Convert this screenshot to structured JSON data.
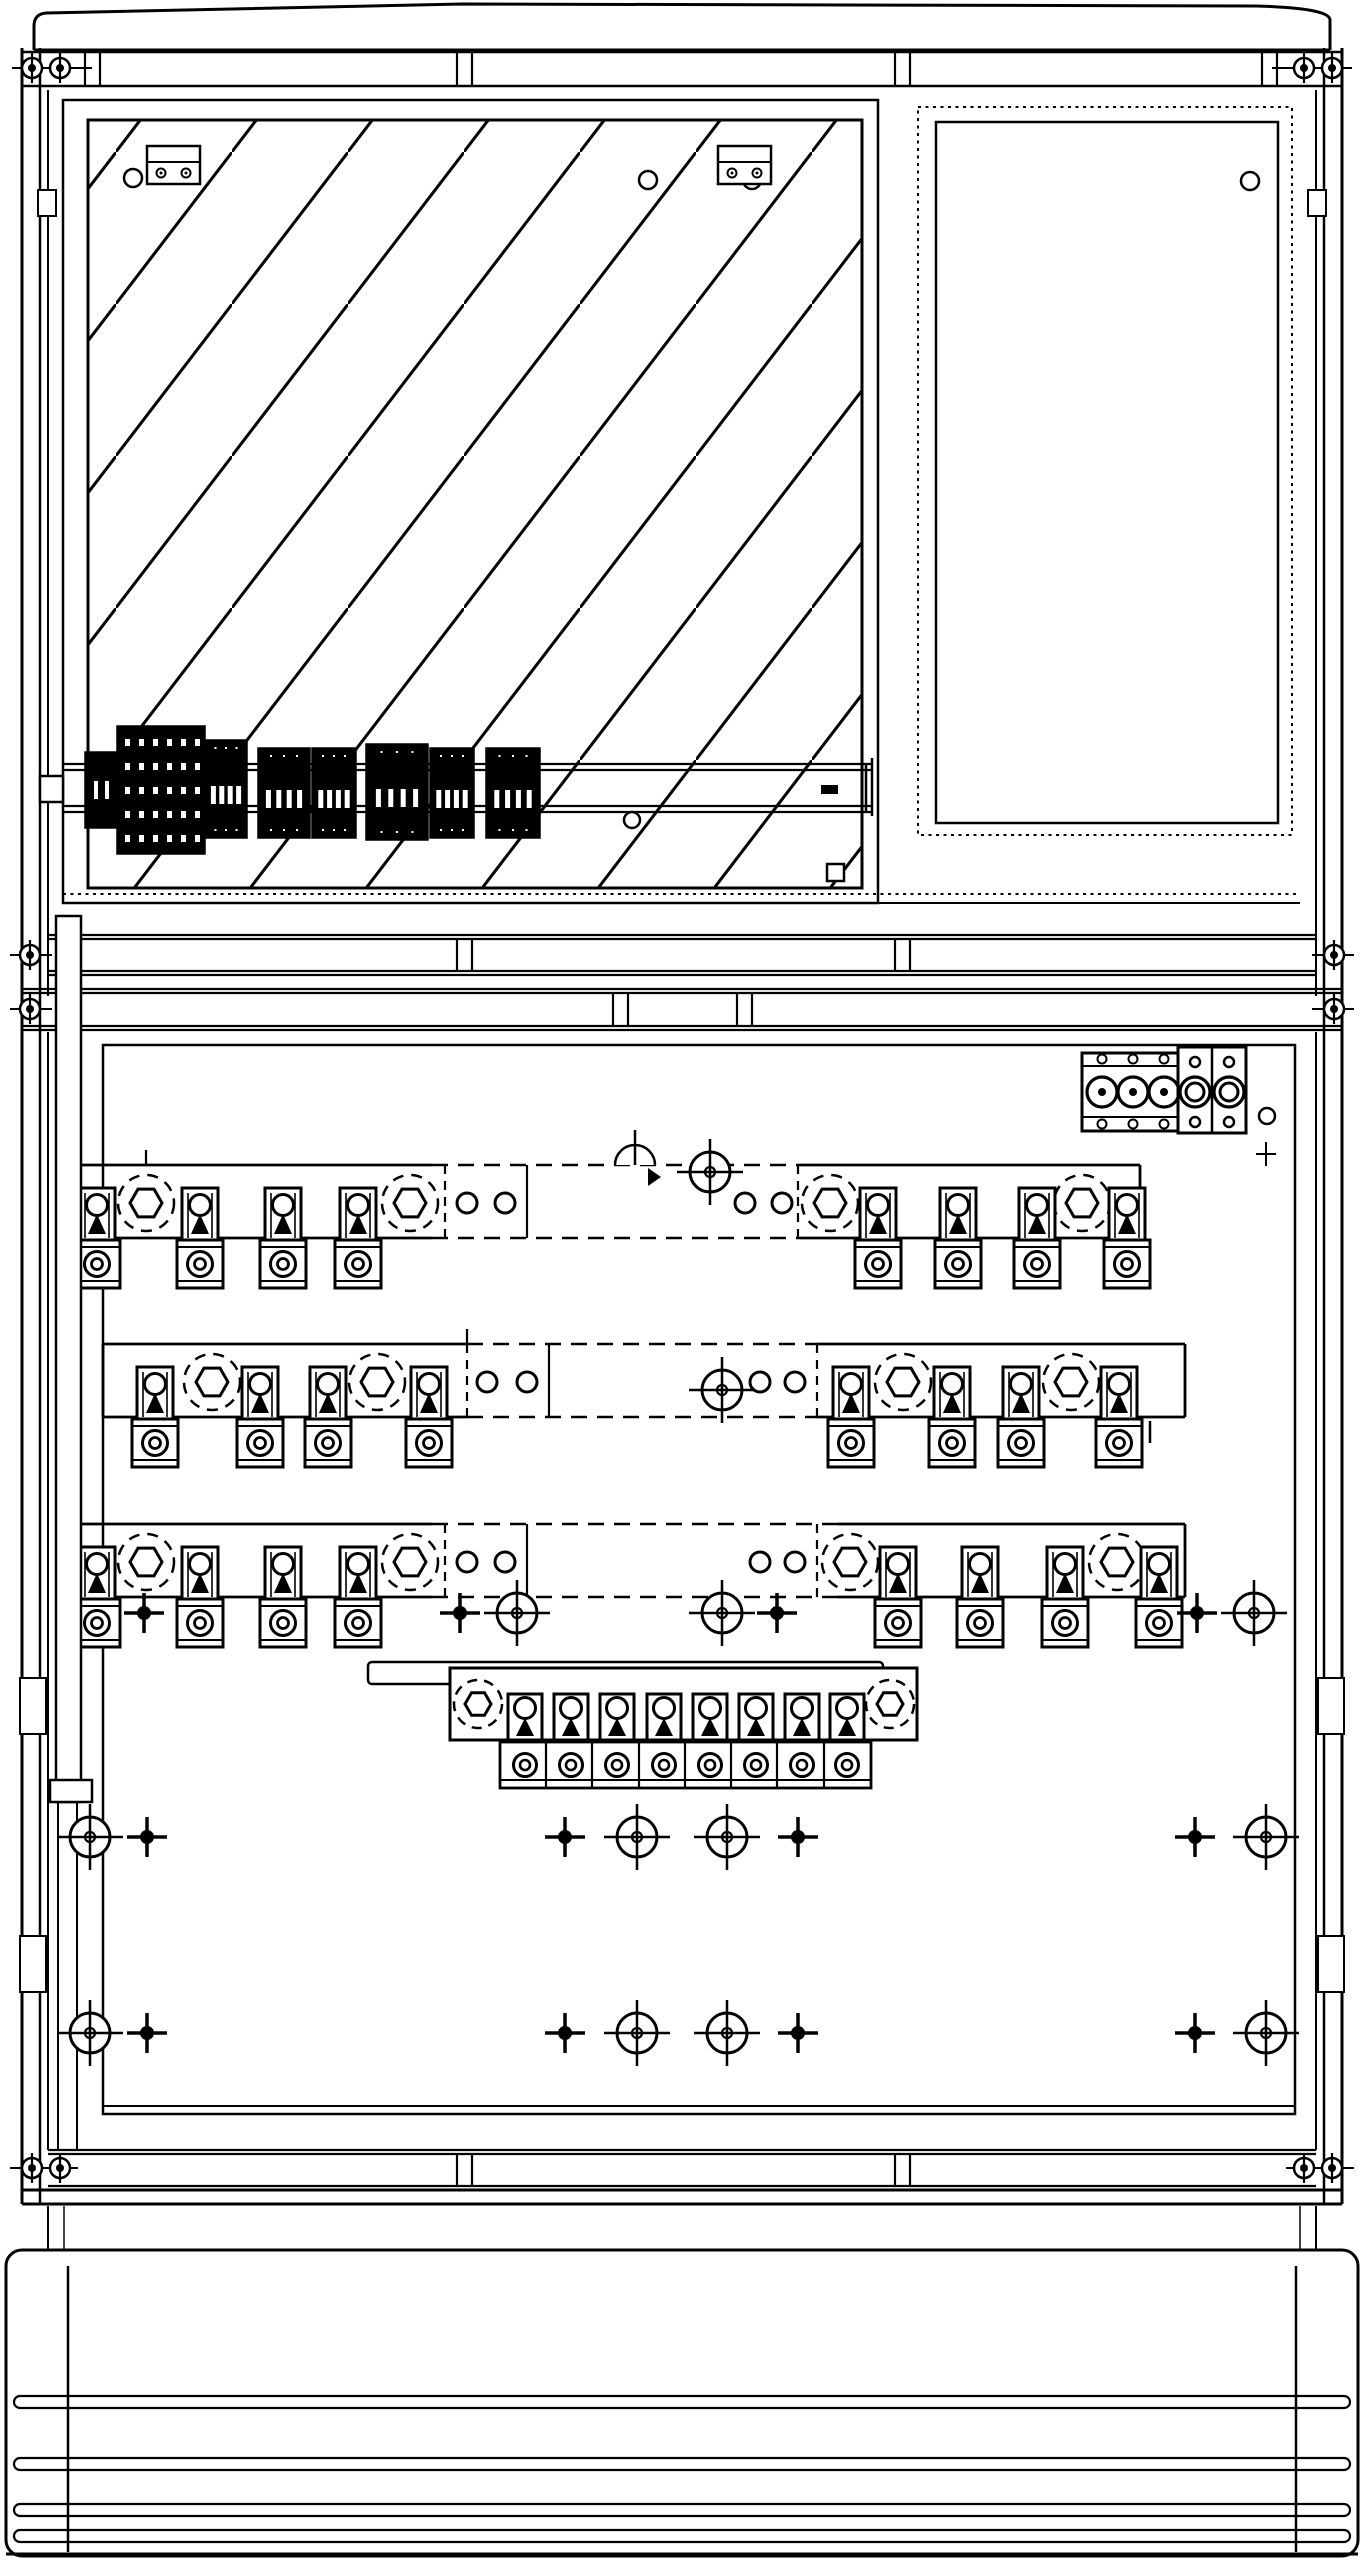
{
  "meta": {
    "title": "Cable distribution cabinet - front view technical line drawing"
  },
  "colors": {
    "line": "#000000",
    "background": "#ffffff"
  },
  "canvas": {
    "width": 1364,
    "height": 2560
  },
  "frame": {
    "cap_path": "M34,50 L34,26 Q34,14 46,13 L462,4 L1256,6 Q1330,8 1330,20 L1330,50",
    "lines": [
      [
        34,
        50,
        1330,
        50,
        3
      ],
      [
        22,
        52,
        1342,
        52,
        2.5
      ],
      [
        22,
        86,
        1342,
        86,
        2.5
      ],
      [
        22,
        48,
        22,
        2204,
        3
      ],
      [
        40,
        48,
        40,
        2204,
        2.5
      ],
      [
        1342,
        48,
        1342,
        2204,
        3
      ],
      [
        1324,
        48,
        1324,
        2204,
        2.5
      ],
      [
        48,
        90,
        48,
        996,
        2
      ],
      [
        1316,
        90,
        1316,
        996,
        2
      ],
      [
        48,
        1032,
        48,
        2150,
        2
      ],
      [
        1316,
        1032,
        1316,
        2150,
        2
      ],
      [
        63,
        894,
        1300,
        894,
        2,
        "3 4.5"
      ],
      [
        63,
        903,
        1300,
        903,
        2
      ],
      [
        48,
        935,
        1316,
        935,
        2.2
      ],
      [
        48,
        939,
        1316,
        939,
        2.2
      ],
      [
        48,
        971,
        1316,
        971,
        2.2
      ],
      [
        48,
        975,
        1316,
        975,
        2.2
      ],
      [
        22,
        989,
        1342,
        989,
        2.2
      ],
      [
        22,
        993,
        1342,
        993,
        2.2
      ],
      [
        22,
        1026,
        1342,
        1026,
        2.2
      ],
      [
        22,
        1030,
        1342,
        1030,
        2.2
      ],
      [
        103,
        2106,
        1295,
        2106,
        2
      ],
      [
        48,
        2150,
        1316,
        2150,
        2.2
      ],
      [
        48,
        2154,
        1316,
        2154,
        2.2
      ],
      [
        48,
        2186,
        1316,
        2186,
        2.2
      ],
      [
        22,
        2190,
        1342,
        2190,
        3
      ],
      [
        22,
        2204,
        1342,
        2204,
        3
      ],
      [
        48,
        2206,
        48,
        2250,
        2
      ],
      [
        1316,
        2206,
        1316,
        2250,
        2
      ],
      [
        64,
        2206,
        64,
        2250,
        1.5
      ],
      [
        1300,
        2206,
        1300,
        2250,
        1.5
      ],
      [
        68,
        2266,
        68,
        2552,
        2.5
      ],
      [
        1296,
        2266,
        1296,
        2552,
        2.5
      ],
      [
        6,
        2554,
        1358,
        2554,
        3
      ],
      [
        58,
        1802,
        58,
        2150,
        2
      ],
      [
        77,
        1802,
        77,
        2150,
        2
      ],
      [
        12,
        68,
        92,
        68,
        2
      ],
      [
        1272,
        68,
        1352,
        68,
        2
      ],
      [
        10,
        955,
        52,
        955,
        2
      ],
      [
        1312,
        955,
        1354,
        955,
        2
      ],
      [
        10,
        1009,
        52,
        1009,
        2
      ],
      [
        1312,
        1009,
        1354,
        1009,
        2
      ],
      [
        10,
        2168,
        78,
        2168,
        2
      ],
      [
        1286,
        2168,
        1354,
        2168,
        2
      ]
    ],
    "rects": [
      [
        63,
        100,
        815,
        803,
        2.5,
        "none"
      ],
      [
        918,
        107,
        374,
        728,
        2,
        "none",
        "3 4.5"
      ],
      [
        936,
        122,
        342,
        701,
        2.5,
        "none"
      ],
      [
        103,
        1045,
        1192,
        1069,
        2.5,
        "none"
      ],
      [
        38,
        190,
        18,
        26,
        2,
        "#ffffff"
      ],
      [
        1308,
        190,
        18,
        26,
        2,
        "#ffffff"
      ],
      [
        20,
        1678,
        26,
        56,
        2,
        "#ffffff"
      ],
      [
        1318,
        1678,
        26,
        56,
        2,
        "#ffffff"
      ],
      [
        20,
        1936,
        26,
        56,
        2,
        "#ffffff"
      ],
      [
        1318,
        1936,
        26,
        56,
        2,
        "#ffffff"
      ]
    ],
    "plinth": {
      "rect": [
        6,
        2250,
        1352,
        306
      ],
      "corner_radius": 16,
      "stroke": 3,
      "grooves_y": [
        2396,
        2458,
        2504,
        2530
      ],
      "groove": {
        "x": 14,
        "w": 1336,
        "h": 12,
        "stroke": 2.2
      }
    },
    "tick_pairs": {
      "gap": 15,
      "stroke": 2.2,
      "sets": [
        {
          "y1": 52,
          "y2": 86,
          "xs": [
            85,
            457,
            895,
            1262
          ]
        },
        {
          "y1": 939,
          "y2": 971,
          "xs": [
            457,
            895
          ]
        },
        {
          "y1": 993,
          "y2": 1026,
          "xs": [
            613,
            737
          ]
        },
        {
          "y1": 2154,
          "y2": 2186,
          "xs": [
            457,
            895
          ]
        }
      ]
    },
    "bolts": [
      {
        "x": 32,
        "y": 68
      },
      {
        "x": 60,
        "y": 68
      },
      {
        "x": 1304,
        "y": 68
      },
      {
        "x": 1332,
        "y": 68
      },
      {
        "x": 30,
        "y": 955
      },
      {
        "x": 1334,
        "y": 955
      },
      {
        "x": 30,
        "y": 1009
      },
      {
        "x": 1334,
        "y": 1009
      },
      {
        "x": 32,
        "y": 2168
      },
      {
        "x": 60,
        "y": 2168
      },
      {
        "x": 1304,
        "y": 2168
      },
      {
        "x": 1332,
        "y": 2168
      }
    ]
  },
  "hatch_panel": {
    "rect": [
      88,
      120,
      774,
      768
    ],
    "pattern": {
      "w": 116,
      "h": 152,
      "stroke": 3
    },
    "circles": [
      [
        133,
        178
      ],
      [
        648,
        180
      ],
      [
        752,
        180
      ]
    ],
    "circle_r": 9,
    "brackets": [
      {
        "x": 147,
        "y": 146
      },
      {
        "x": 718,
        "y": 146
      }
    ],
    "bracket": {
      "w": 53,
      "h": 38,
      "divider_y": 16,
      "screw_dx": [
        14,
        39
      ],
      "screw_dy": 27,
      "screw_r": 4.5
    }
  },
  "door_panel": {
    "circle": [
      1250,
      181,
      9
    ]
  },
  "din_rail": {
    "lines": [
      [
        63,
        764,
        872,
        764
      ],
      [
        63,
        770,
        872,
        770
      ],
      [
        63,
        806,
        872,
        806
      ],
      [
        63,
        812,
        872,
        812
      ]
    ],
    "line_w": 2.2,
    "end_verticals": [
      [
        866,
        764,
        866,
        812
      ],
      [
        872,
        758,
        872,
        816
      ]
    ],
    "left_connector": [
      40,
      776,
      23,
      26
    ],
    "dots": [
      [
        92,
        816
      ],
      [
        104,
        816
      ]
    ],
    "dot_r": 3,
    "dash_mark": [
      822,
      786,
      15,
      7
    ],
    "square_mark": [
      827,
      864,
      17,
      17
    ],
    "circle_below": [
      632,
      820,
      8
    ],
    "blocks": [
      {
        "x": 85,
        "y": 752,
        "w": 32,
        "h": 76,
        "kind": "side"
      },
      {
        "x": 117,
        "y": 726,
        "w": 88,
        "h": 128,
        "kind": "big"
      },
      {
        "x": 205,
        "y": 740,
        "w": 42,
        "h": 98,
        "kind": "std"
      },
      {
        "x": 258,
        "y": 748,
        "w": 52,
        "h": 90,
        "kind": "std"
      },
      {
        "x": 312,
        "y": 748,
        "w": 44,
        "h": 90,
        "kind": "std"
      },
      {
        "x": 366,
        "y": 744,
        "w": 62,
        "h": 96,
        "kind": "std"
      },
      {
        "x": 430,
        "y": 748,
        "w": 44,
        "h": 90,
        "kind": "std"
      },
      {
        "x": 486,
        "y": 748,
        "w": 54,
        "h": 90,
        "kind": "std"
      }
    ]
  },
  "duct": {
    "body": [
      56,
      916,
      25,
      886
    ],
    "foot": [
      50,
      1780,
      42,
      22
    ]
  },
  "connector_block": {
    "block_a": {
      "rect": [
        1082,
        1053,
        96,
        78
      ],
      "h_lines_y": [
        1066,
        1117
      ],
      "big_circles_x": [
        1102,
        1133,
        1164
      ],
      "big_circle_y": 1092,
      "big_r": 15,
      "dot_r": 4,
      "small_circles_y": [
        1059,
        1124
      ],
      "small_r": 4.5
    },
    "block_b": {
      "rect": [
        1178,
        1047,
        68,
        86
      ],
      "divider_x": 1212,
      "cells_x": [
        1195,
        1229
      ],
      "ring_y": 1092,
      "ring_r": [
        15,
        9
      ],
      "small_y": [
        1062,
        1122
      ],
      "small_r": 5
    },
    "side_circle": [
      1267,
      1116,
      8
    ],
    "mini_plus": [
      1266,
      1154
    ]
  },
  "busbar_style": {
    "band_h": 73,
    "bar_stroke": 2.8,
    "hidden_dash": "16 10",
    "clamp": {
      "w": 36,
      "h": 54,
      "dy": 23
    },
    "pad": {
      "w": 46,
      "h": 48,
      "dy": 75
    },
    "hex": {
      "ring_r": 28,
      "hex_r": 16
    },
    "circle_r": 10
  },
  "busbar_rows": [
    {
      "name": "busbar-row-L1",
      "band_top": 1165,
      "x1": 80,
      "x2": 1140,
      "dashed": [
        432,
        800
      ],
      "hexes": [
        146,
        410,
        830,
        1082
      ],
      "clamps": [
        97,
        200,
        283,
        358,
        878,
        958,
        1037,
        1127
      ],
      "circles": [
        467,
        505,
        745,
        782
      ],
      "targets": [
        [
          710,
          1172
        ]
      ],
      "half_markers": [
        [
          635,
          1165
        ]
      ],
      "dash_verts": [
        445,
        798
      ],
      "solid_verts": [
        527
      ],
      "top_ticks": [
        146
      ],
      "end_ticks": [
        [
          1145,
          1242
        ]
      ]
    },
    {
      "name": "busbar-row-L2",
      "band_top": 1344,
      "x1": 103,
      "x2": 1185,
      "dashed": [
        467,
        817
      ],
      "hexes": [
        212,
        377,
        903,
        1071
      ],
      "clamps": [
        155,
        260,
        328,
        429,
        851,
        952,
        1021,
        1119
      ],
      "circles": [
        487,
        527,
        760,
        795
      ],
      "targets": [
        [
          722,
          1390
        ]
      ],
      "half_markers": [],
      "dash_verts": [
        467,
        817
      ],
      "solid_verts": [
        549
      ],
      "top_ticks": [
        467
      ],
      "end_ticks": [
        [
          1150,
          1421
        ]
      ]
    },
    {
      "name": "busbar-row-L3",
      "band_top": 1524,
      "x1": 80,
      "x2": 1185,
      "dashed": [
        432,
        838
      ],
      "hexes": [
        146,
        410,
        850,
        1117
      ],
      "clamps": [
        97,
        200,
        283,
        358,
        898,
        980,
        1065,
        1159
      ],
      "circles": [
        467,
        505,
        760,
        795
      ],
      "targets": [],
      "half_markers": [],
      "dash_verts": [
        445,
        817
      ],
      "solid_verts": [
        527
      ],
      "top_ticks": [],
      "end_ticks": []
    }
  ],
  "neutral_assembly": {
    "back_rail": [
      368,
      1662,
      515,
      22
    ],
    "bar": [
      450,
      1668,
      467,
      72
    ],
    "hexes": [
      [
        478,
        1704
      ],
      [
        890,
        1704
      ]
    ],
    "hex": {
      "ring_r": 24,
      "hex_r": 13
    },
    "clamp_xs": [
      525,
      571,
      617,
      664,
      710,
      756,
      802,
      847
    ],
    "clamp_top": 1694,
    "pad_strip": [
      500,
      1742,
      371,
      46
    ],
    "pad_dividers": [
      546,
      592,
      639,
      685,
      731,
      777,
      824
    ],
    "pad_y": 1765,
    "strip_line_y": 1780
  },
  "marker_rows": [
    {
      "y": 1613,
      "plus": [
        144,
        460,
        777,
        1197
      ],
      "targets": [
        517,
        722,
        1254
      ]
    },
    {
      "y": 1837,
      "plus": [
        147,
        565,
        798,
        1195
      ],
      "targets": [
        90,
        637,
        727,
        1266
      ]
    },
    {
      "y": 2033,
      "plus": [
        147,
        565,
        798,
        1195
      ],
      "targets": [
        90,
        637,
        727,
        1266
      ]
    }
  ],
  "symbols": {
    "target": {
      "r": 20,
      "arm": 33
    },
    "plus": {
      "arm": 20,
      "dot_r": 7
    },
    "bolt": {
      "r": 10,
      "dot_r": 4,
      "stem": 15
    }
  }
}
